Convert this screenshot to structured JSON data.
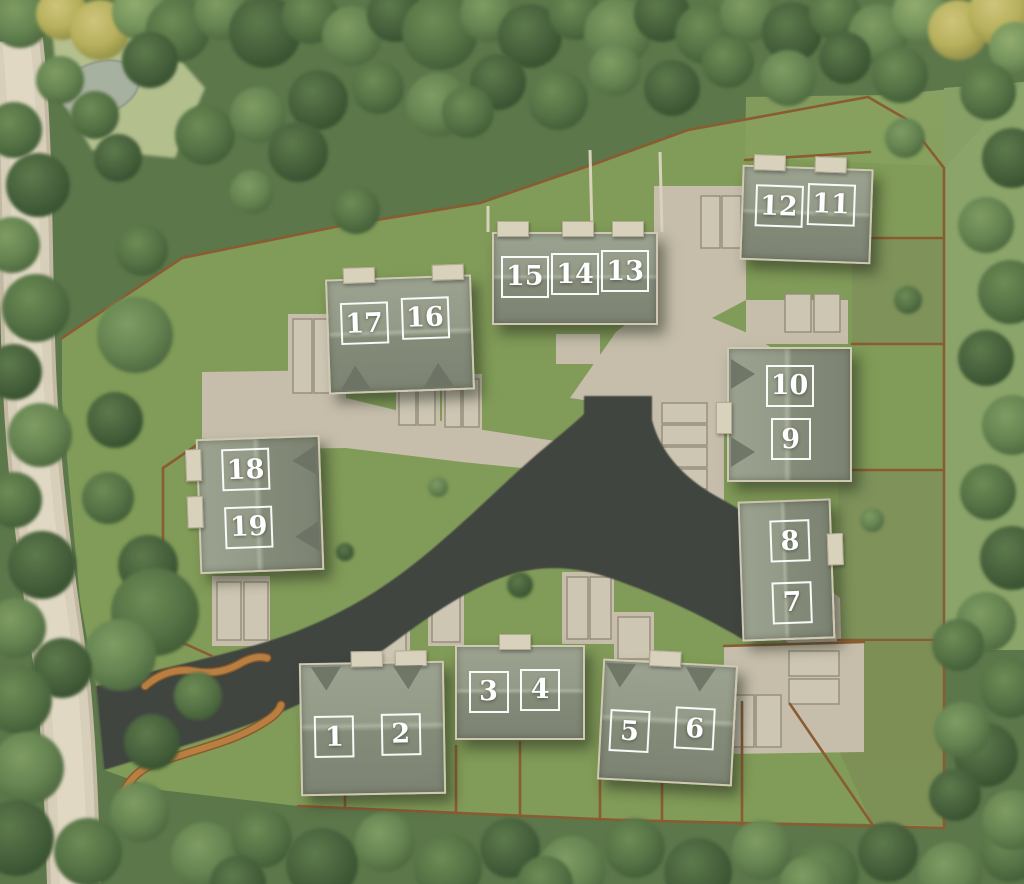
{
  "site": {
    "name": "aerial-development-site-plan",
    "plot_count": 19,
    "plot_labels": [
      "1",
      "2",
      "3",
      "4",
      "5",
      "6",
      "7",
      "8",
      "9",
      "10",
      "11",
      "12",
      "13",
      "14",
      "15",
      "16",
      "17",
      "18",
      "19"
    ]
  },
  "colors": {
    "woodland": "#5c774a",
    "lawn": "#819b58",
    "rough_grass": "#8ba469",
    "asphalt_road": "#414441",
    "country_lane": "#d8cfba",
    "paving": "#c6beab",
    "roof_light": "#9ba290",
    "roof_dark": "#7c8372",
    "fence": "#8a5c33",
    "brick_wall": "#b0763c",
    "plaque_border": "#ffffff",
    "plaque_text": "#ffffff"
  },
  "buildings": [
    {
      "id": "building-plots-1-2",
      "x": 300,
      "y": 662,
      "w": 145,
      "h": 133,
      "rot": -1,
      "ridge": "h",
      "dormers": {
        "side": "n",
        "pos": [
          0.17,
          0.74
        ]
      },
      "porches": [
        {
          "side": "n",
          "pos": 0.45
        },
        {
          "side": "n",
          "pos": 0.75
        }
      ],
      "plots": [
        {
          "label": "1",
          "cx": 0.23,
          "cy": 0.56
        },
        {
          "label": "2",
          "cx": 0.7,
          "cy": 0.55
        }
      ]
    },
    {
      "id": "building-plots-3-4",
      "x": 455,
      "y": 645,
      "w": 130,
      "h": 95,
      "rot": 0,
      "ridge": "h",
      "dormers": null,
      "porches": [
        {
          "side": "n",
          "pos": 0.44
        }
      ],
      "plots": [
        {
          "label": "3",
          "cx": 0.25,
          "cy": 0.49
        },
        {
          "label": "4",
          "cx": 0.66,
          "cy": 0.47
        }
      ]
    },
    {
      "id": "building-plots-5-6",
      "x": 600,
      "y": 662,
      "w": 135,
      "h": 121,
      "rot": 3,
      "ridge": "h",
      "dormers": {
        "side": "n",
        "pos": [
          0.12,
          0.71
        ]
      },
      "porches": [
        {
          "side": "n",
          "pos": 0.44
        }
      ],
      "plots": [
        {
          "label": "5",
          "cx": 0.215,
          "cy": 0.59
        },
        {
          "label": "6",
          "cx": 0.71,
          "cy": 0.54
        }
      ]
    },
    {
      "id": "building-plots-7-8",
      "x": 740,
      "y": 500,
      "w": 93,
      "h": 140,
      "rot": -2,
      "ridge": "v",
      "dormers": null,
      "porches": [
        {
          "side": "e",
          "pos": 0.34
        }
      ],
      "plots": [
        {
          "label": "8",
          "cx": 0.55,
          "cy": 0.29
        },
        {
          "label": "7",
          "cx": 0.55,
          "cy": 0.74
        }
      ]
    },
    {
      "id": "building-plots-9-10",
      "x": 727,
      "y": 347,
      "w": 125,
      "h": 135,
      "rot": 0,
      "ridge": "v",
      "dormers": {
        "side": "w",
        "pos": [
          0.185,
          0.76
        ]
      },
      "porches": [
        {
          "side": "w",
          "pos": 0.5
        }
      ],
      "plots": [
        {
          "label": "10",
          "cx": 0.5,
          "cy": 0.28
        },
        {
          "label": "9",
          "cx": 0.51,
          "cy": 0.69
        }
      ]
    },
    {
      "id": "building-plots-11-12",
      "x": 741,
      "y": 167,
      "w": 131,
      "h": 95,
      "rot": 2,
      "ridge": "h",
      "dormers": null,
      "porches": [
        {
          "side": "n",
          "pos": 0.18
        },
        {
          "side": "n",
          "pos": 0.65
        }
      ],
      "plots": [
        {
          "label": "12",
          "cx": 0.28,
          "cy": 0.42
        },
        {
          "label": "11",
          "cx": 0.69,
          "cy": 0.38
        }
      ]
    },
    {
      "id": "building-plots-13-14-15",
      "x": 492,
      "y": 232,
      "w": 166,
      "h": 93,
      "rot": 0,
      "ridge": "h",
      "dormers": null,
      "porches": [
        {
          "side": "n",
          "pos": 0.11
        },
        {
          "side": "n",
          "pos": 0.5
        },
        {
          "side": "n",
          "pos": 0.8
        }
      ],
      "plots": [
        {
          "label": "15",
          "cx": 0.19,
          "cy": 0.48
        },
        {
          "label": "14",
          "cx": 0.5,
          "cy": 0.45
        },
        {
          "label": "13",
          "cx": 0.81,
          "cy": 0.42
        }
      ]
    },
    {
      "id": "building-plots-16-17",
      "x": 327,
      "y": 277,
      "w": 146,
      "h": 115,
      "rot": -2,
      "ridge": "h",
      "dormers": {
        "side": "s",
        "pos": [
          0.17,
          0.74
        ]
      },
      "porches": [
        {
          "side": "n",
          "pos": 0.21
        },
        {
          "side": "n",
          "pos": 0.82
        }
      ],
      "plots": [
        {
          "label": "17",
          "cx": 0.25,
          "cy": 0.39
        },
        {
          "label": "16",
          "cx": 0.68,
          "cy": 0.36
        }
      ]
    },
    {
      "id": "building-plots-18-19",
      "x": 198,
      "y": 437,
      "w": 124,
      "h": 135,
      "rot": -2,
      "ridge": "v",
      "dormers": {
        "side": "e",
        "pos": [
          0.17,
          0.73
        ]
      },
      "porches": [
        {
          "side": "w",
          "pos": 0.17
        },
        {
          "side": "w",
          "pos": 0.52
        }
      ],
      "plots": [
        {
          "label": "18",
          "cx": 0.39,
          "cy": 0.23
        },
        {
          "label": "19",
          "cx": 0.4,
          "cy": 0.67
        }
      ]
    }
  ]
}
